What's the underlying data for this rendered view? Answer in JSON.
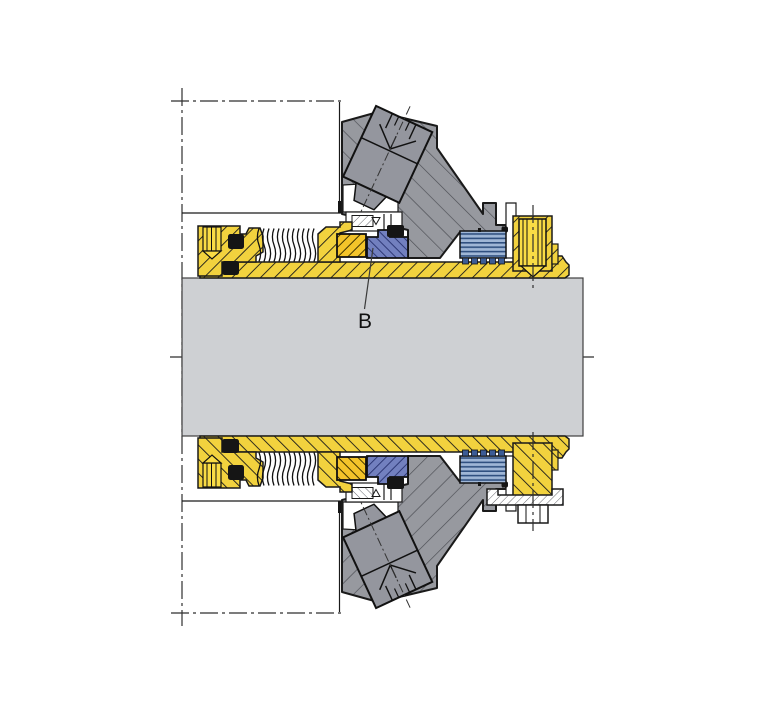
{
  "annotation": {
    "label": "B"
  },
  "colors": {
    "line": "#1a1a1a",
    "centerline": "#2f2f2f",
    "shaft": "#ced0d3",
    "clamp": "#97999f",
    "clampHatch": "#4a4c52",
    "screwGray": "#94969e",
    "yellow": "#f2d23e",
    "gold": "#f4c42a",
    "screwYellow": "#f9dc45",
    "blueFace": "#7280bf",
    "blueFaceHatch": "#26306e",
    "bellows": "#9fb6d6",
    "bellowsLine": "#305080",
    "teeth": "#3c5c96",
    "black": "#151515",
    "background": "#ffffff"
  }
}
